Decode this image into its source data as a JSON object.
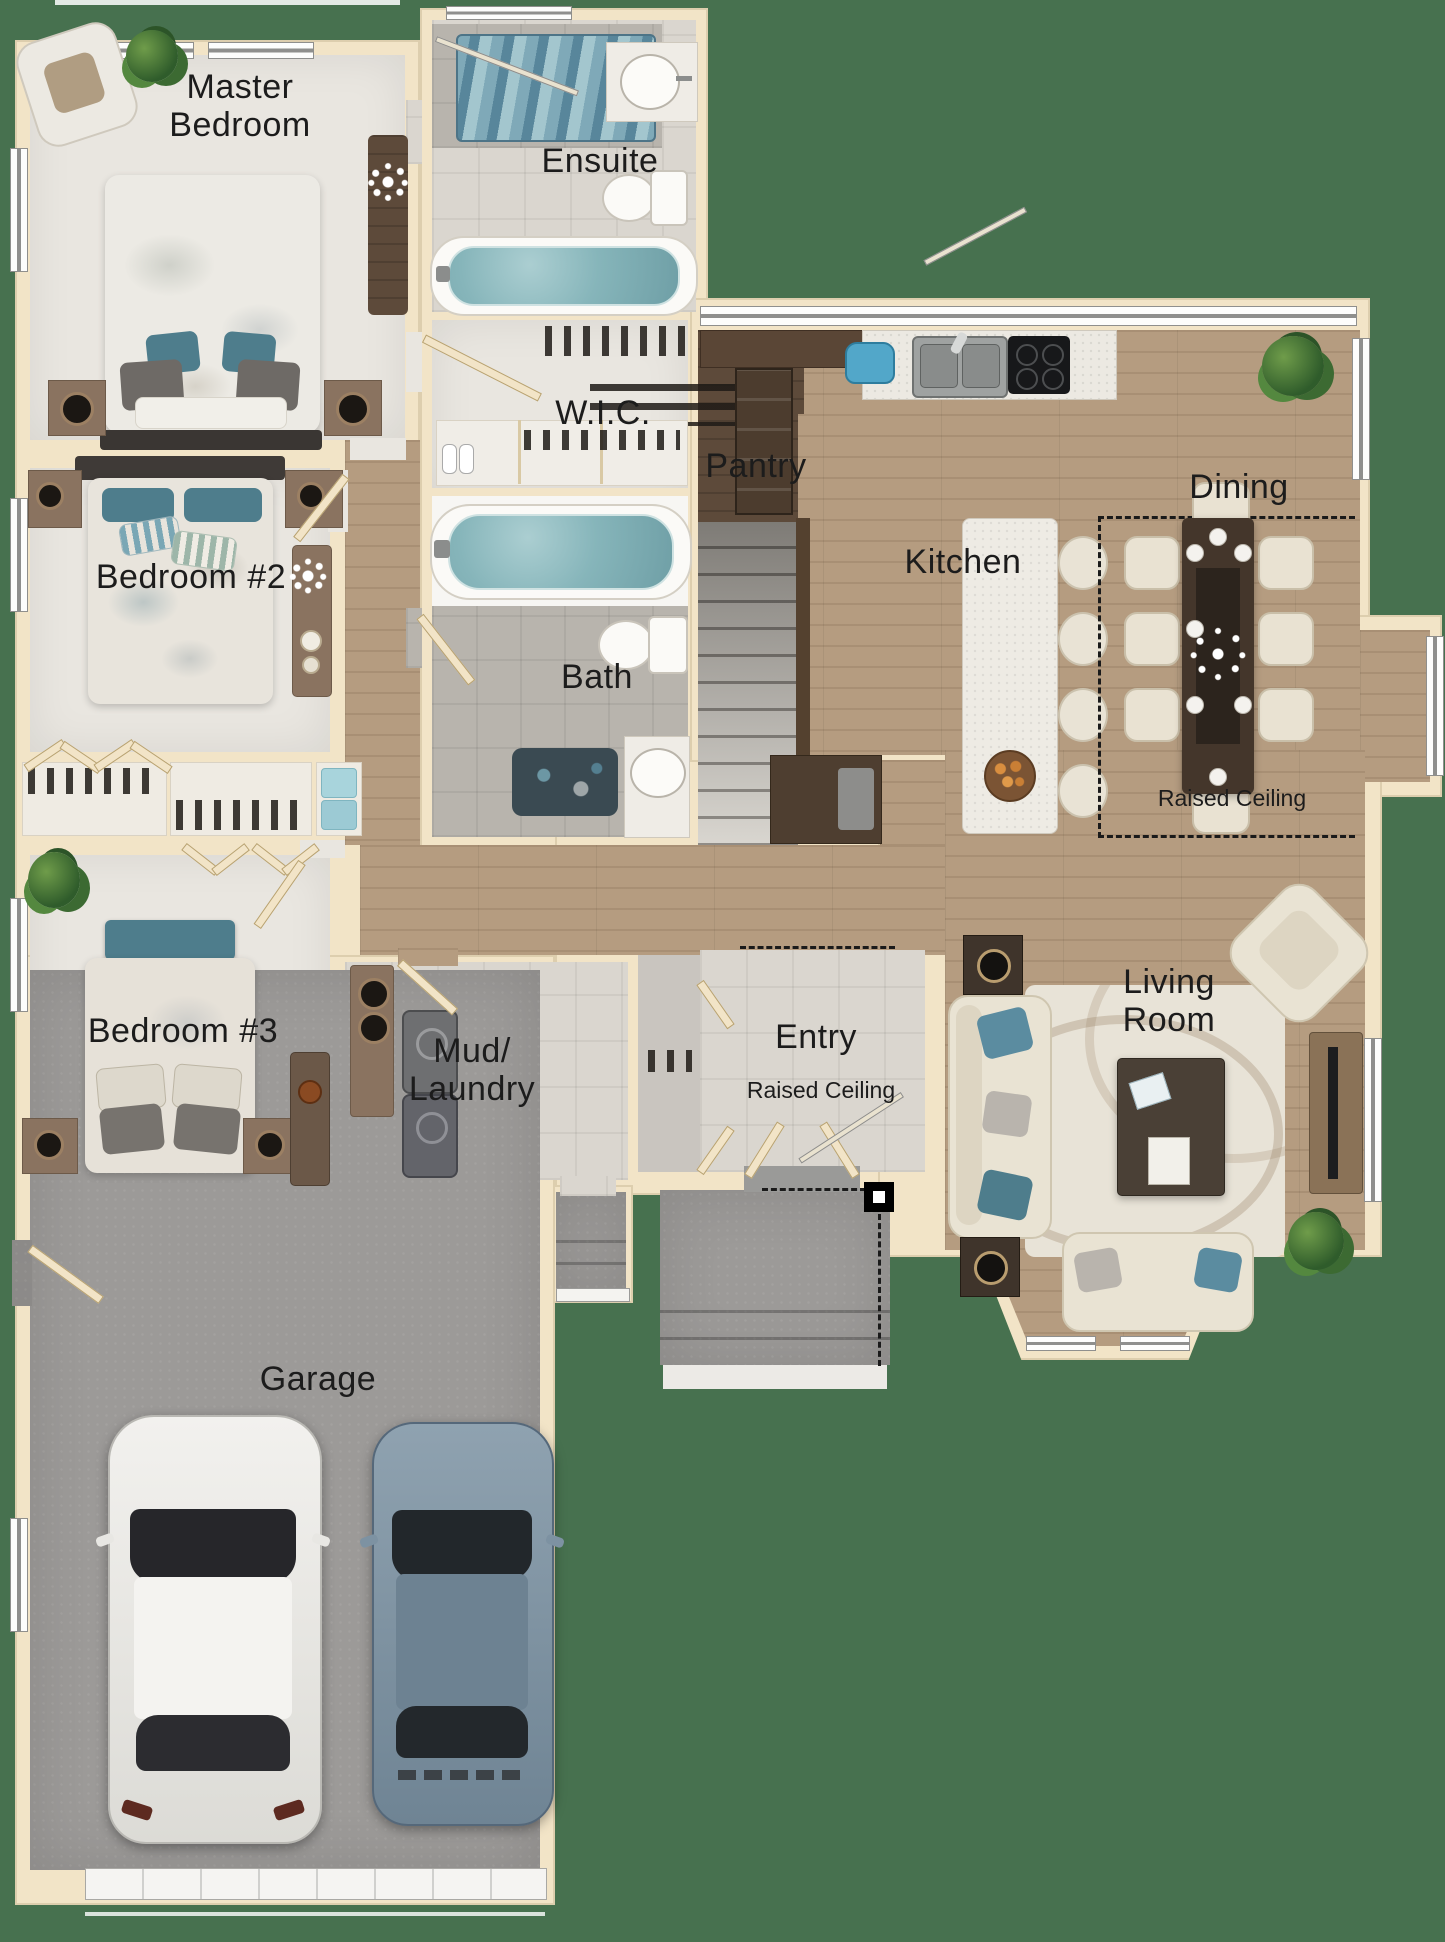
{
  "title": "House Floor Plan",
  "colors": {
    "exterior_green": "#47714f",
    "wall_cream": "#f2e4c7",
    "wood_floor": "#b59c80",
    "dark_wood": "#5d4a3a",
    "carpet": "#e9e6e0",
    "tile_light": "#dad6cf",
    "tile_gray": "#b8b4ad",
    "concrete": "#9c9a98",
    "water_blue": "#86b5ba",
    "accent_teal": "#4e7d8c",
    "label_color": "#1c1c1c"
  },
  "rooms": [
    {
      "id": "master-bedroom",
      "label": "Master Bedroom"
    },
    {
      "id": "ensuite",
      "label": "Ensuite"
    },
    {
      "id": "wic",
      "label": "W.I.C."
    },
    {
      "id": "pantry",
      "label": "Pantry"
    },
    {
      "id": "kitchen",
      "label": "Kitchen"
    },
    {
      "id": "dining",
      "label": "Dining",
      "sublabel": "Raised Ceiling"
    },
    {
      "id": "bedroom-2",
      "label": "Bedroom #2"
    },
    {
      "id": "bath",
      "label": "Bath"
    },
    {
      "id": "bedroom-3",
      "label": "Bedroom #3"
    },
    {
      "id": "mud-laundry",
      "label": "Mud/ Laundry"
    },
    {
      "id": "entry",
      "label": "Entry",
      "sublabel": "Raised Ceiling"
    },
    {
      "id": "living-room",
      "label": "Living Room"
    },
    {
      "id": "garage",
      "label": "Garage"
    }
  ]
}
